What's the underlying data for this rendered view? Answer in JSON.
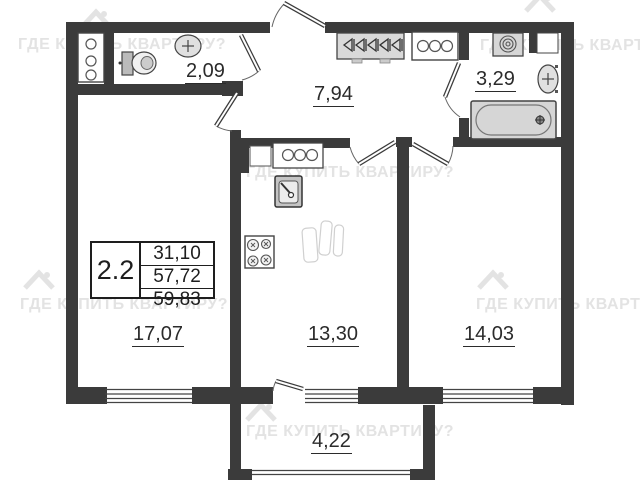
{
  "watermark": {
    "text": "ГДЕ КУПИТЬ КВАРТИРУ?"
  },
  "info_table": {
    "unit": "2.2",
    "living_area": "31,10",
    "area": "57,72",
    "total_area": "59,83"
  },
  "rooms": {
    "wc": "2,09",
    "hallway": "7,94",
    "bathroom": "3,29",
    "living_room": "17,07",
    "kitchen": "13,30",
    "bedroom": "14,03",
    "balcony": "4,22"
  }
}
